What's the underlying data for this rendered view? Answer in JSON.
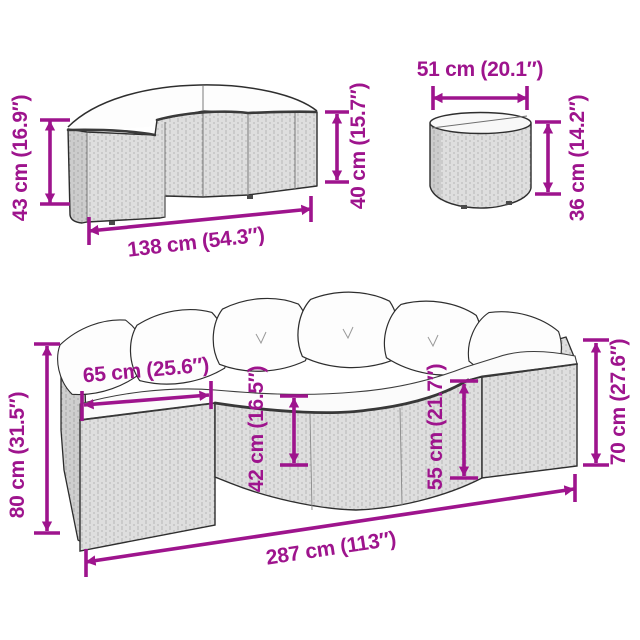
{
  "diagram_type": "furniture-dimension-diagram",
  "colors": {
    "dimension": "#9E148D",
    "outline": "#2E2E2E",
    "wicker_fill": "#EBEBEB",
    "wicker_line": "#A6A6A6",
    "cushion": "#FDFDFD",
    "background": "#FFFFFF"
  },
  "bench": {
    "left": "43 cm (16.9″)",
    "bottom": "138 cm (54.3″)",
    "right": "40 cm (15.7″)"
  },
  "table": {
    "top": "51 cm (20.1″)",
    "right": "36 cm (14.2″)"
  },
  "sofa": {
    "left": "80 cm (31.5″)",
    "inner_top": "65 cm (25.6″)",
    "center_left": "42 cm (16.5″)",
    "center_right": "55 cm (21.7″)",
    "right": "70 cm (27.6″)",
    "bottom": "287 cm (113″)"
  }
}
